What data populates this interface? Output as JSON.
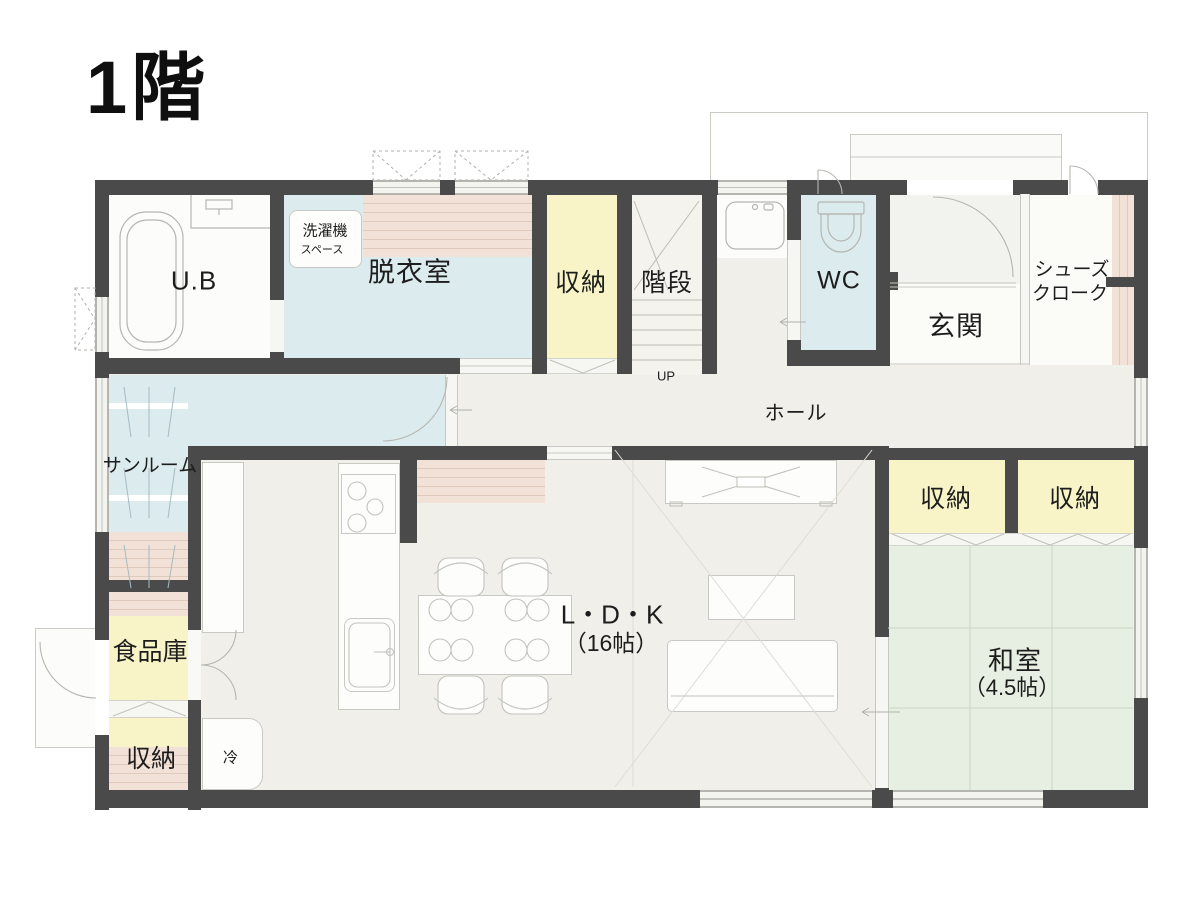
{
  "title": "1階",
  "colors": {
    "wall": "#4a4a4a",
    "floor_base": "#f0efe9",
    "water_blue": "#dcebee",
    "storage_yellow": "#f8f4c7",
    "tatami_green": "#e7efe2",
    "shelf_pink": "#f2e1d6",
    "text": "#1d1d1d"
  },
  "labels": {
    "unit_bath": "U.B",
    "washer_space_l1": "洗濯機",
    "washer_space_l2": "スペース",
    "dressing_room": "脱衣室",
    "storage_top": "収納",
    "stairs": "階段",
    "stairs_up": "UP",
    "wc": "WC",
    "entrance": "玄関",
    "shoe_closet_l1": "シューズ",
    "shoe_closet_l2": "クローク",
    "hall": "ホール",
    "sunroom": "サンルーム",
    "pantry": "食品庫",
    "storage_bottom_left": "収納",
    "fridge": "冷",
    "ldk_l1": "L・D・K",
    "ldk_l2": "（16帖）",
    "storage_right_1": "収納",
    "storage_right_2": "収納",
    "japanese_room_l1": "和室",
    "japanese_room_l2": "（4.5帖）"
  }
}
